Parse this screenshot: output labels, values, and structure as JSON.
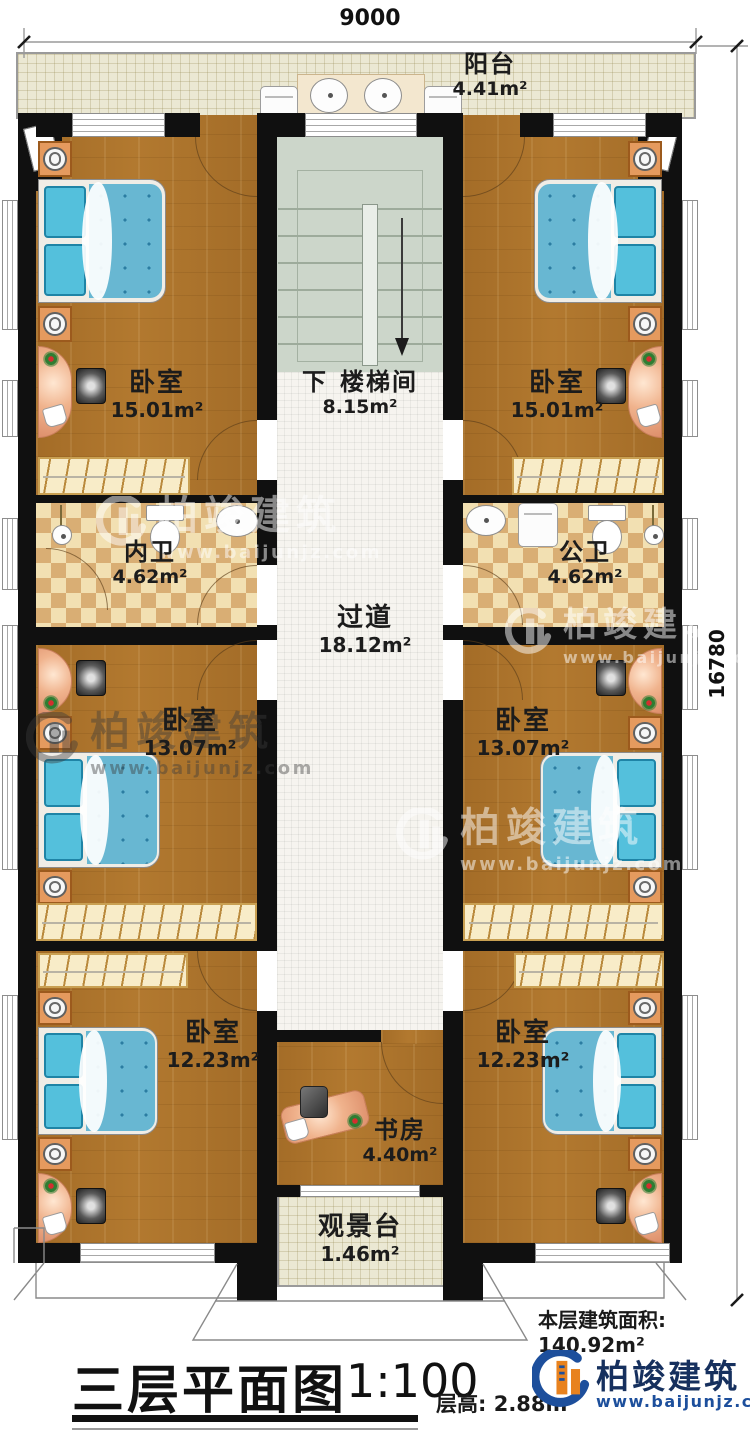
{
  "dimensions": {
    "top": "9000",
    "right": "16780"
  },
  "rooms": {
    "balcony": {
      "name": "阳台",
      "area": "4.41m²"
    },
    "stairwell": {
      "down": "下",
      "name": "楼梯间",
      "area": "8.15m²"
    },
    "bedroom_top_left": {
      "name": "卧室",
      "area": "15.01m²"
    },
    "bedroom_top_right": {
      "name": "卧室",
      "area": "15.01m²"
    },
    "bathroom_inner": {
      "name": "内卫",
      "area": "4.62m²"
    },
    "bathroom_public": {
      "name": "公卫",
      "area": "4.62m²"
    },
    "corridor": {
      "name": "过道",
      "area": "18.12m²"
    },
    "bedroom_mid_left": {
      "name": "卧室",
      "area": "13.07m²"
    },
    "bedroom_mid_right": {
      "name": "卧室",
      "area": "13.07m²"
    },
    "bedroom_bottom_left": {
      "name": "卧室",
      "area": "12.23m²"
    },
    "bedroom_bottom_right": {
      "name": "卧室",
      "area": "12.23m²"
    },
    "study": {
      "name": "书房",
      "area": "4.40m²"
    },
    "view_deck": {
      "name": "观景台",
      "area": "1.46m²"
    }
  },
  "footer": {
    "floor_area_label": "本层建筑面积:",
    "floor_area_value": "140.92m²",
    "title": "三层平面图",
    "scale": "1:100",
    "floor_height_label": "层高:",
    "floor_height_value": "2.88m"
  },
  "branding": {
    "company": "柏竣建筑",
    "website": "www.baijunjz.com"
  },
  "colors": {
    "logo_blue": "#1d4f9c",
    "logo_orange": "#e8821e",
    "wall": "#101010",
    "wood": "#b0772e",
    "bed": "#68b7d2"
  }
}
